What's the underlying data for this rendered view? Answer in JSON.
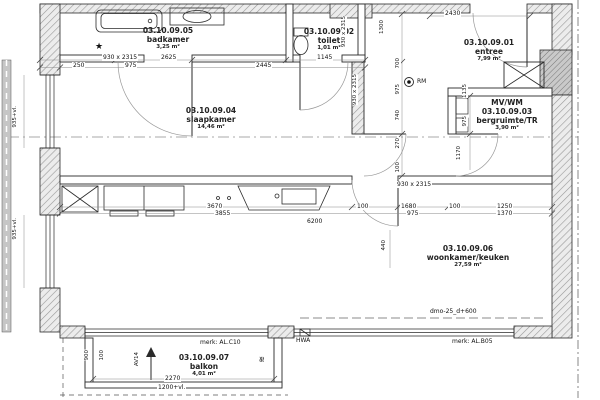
{
  "rooms": {
    "badkamer": {
      "code": "03.10.09.05",
      "name": "badkamer",
      "area": "3,25 m²"
    },
    "toilet": {
      "code": "03.10.09.02",
      "name": "toilet",
      "area": "1,01 m²"
    },
    "entree": {
      "code": "03.10.09.01",
      "name": "entree",
      "area": "7,99 m²"
    },
    "slaapkamer": {
      "code": "03.10.09.04",
      "name": "slaapkamer",
      "area": "14,46 m²"
    },
    "bergruimte": {
      "prefix": "MV/WM",
      "code": "03.10.09.03",
      "name": "bergruimte/TR",
      "area": "3,90 m²"
    },
    "woonkamer": {
      "code": "03.10.09.06",
      "name": "woonkamer/keuken",
      "area": "27,59 m²"
    },
    "balkon": {
      "code": "03.10.09.07",
      "name": "balkon",
      "area": "4,01 m²"
    }
  },
  "dims": {
    "h": {
      "badkamer_door": "930 x 2315",
      "w2625": "2625",
      "w1145": "1145",
      "w250": "250",
      "w975": "975",
      "w2445": "2445",
      "w2430": "2430",
      "w3670": "3670",
      "w3855": "3855",
      "w6200": "6200",
      "w100a": "100",
      "w1680": "1680",
      "w100b": "100",
      "w1250": "1250",
      "w975b": "975",
      "w1370": "1370",
      "berg_door": "930 x 2315",
      "balkon_2270": "2270",
      "balkon_level": "1200+vl."
    },
    "v": {
      "v1300": "1300",
      "toilet_door": "930 x 2315",
      "corridor_door": "930 x 2315",
      "v700": "700",
      "v975": "975",
      "v740": "740",
      "v270": "270",
      "v100": "100",
      "v440": "440",
      "berg1": "1135",
      "berg2": "975",
      "berg3": "1170",
      "window1": "935+vl.",
      "window2": "935+vl.",
      "balkon_900": "900",
      "balkon_100": "100",
      "balkon_code": "AV14"
    }
  },
  "annotations": {
    "merk_balkon": "merk: AL.C10",
    "merk_facade": "merk: AL.B05",
    "hwa": "HWA",
    "rm": "RM",
    "dmo": "dmo-25_d+600",
    "star": "★",
    "squiggle": "≋"
  }
}
